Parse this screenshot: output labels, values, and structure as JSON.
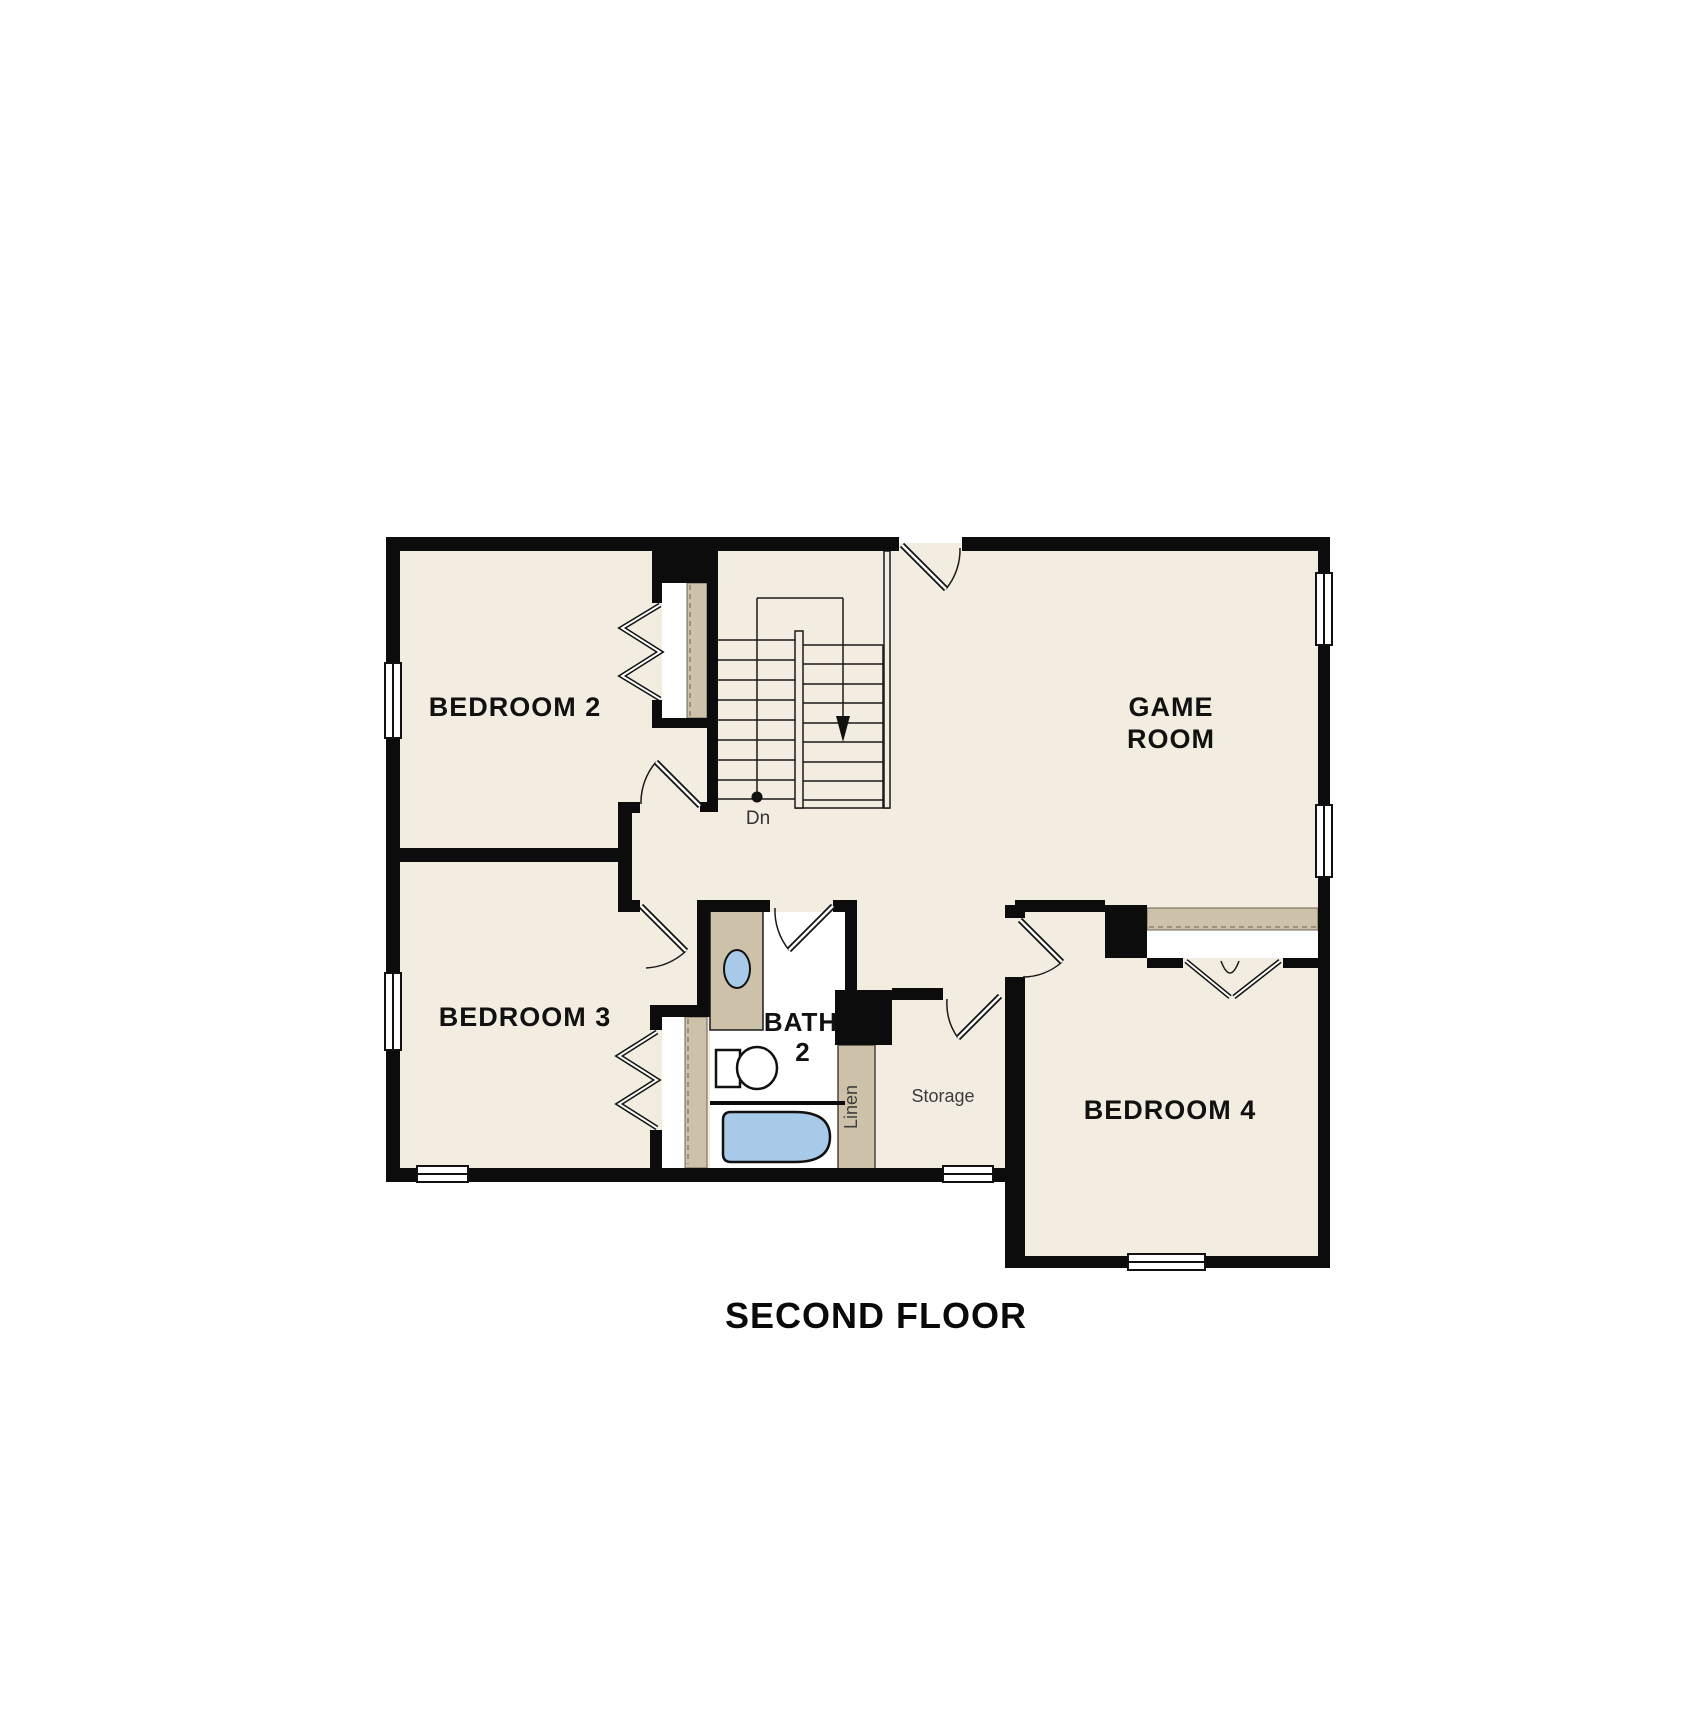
{
  "title": "SECOND FLOOR",
  "rooms": {
    "bedroom2": {
      "label": "BEDROOM 2"
    },
    "bedroom3": {
      "label": "BEDROOM 3"
    },
    "bedroom4": {
      "label": "BEDROOM 4"
    },
    "game_room": {
      "label_line1": "GAME",
      "label_line2": "ROOM"
    },
    "bath2": {
      "label_line1": "BATH",
      "label_line2": "2"
    },
    "storage": {
      "label": "Storage"
    },
    "linen": {
      "label": "Linen"
    }
  },
  "annotations": {
    "stairs_direction": "Dn"
  },
  "palette": {
    "background": "#ffffff",
    "floor": "#f2ede0",
    "bath_floor": "#ffffff",
    "wall": "#0c0c0c",
    "cabinetry_tan": "#cdc2a9",
    "dashed_rod": "#8a8170",
    "fixture_blue": "#a9c9e9",
    "label_text": "#111111",
    "annotation_text": "#3d3d3d"
  }
}
